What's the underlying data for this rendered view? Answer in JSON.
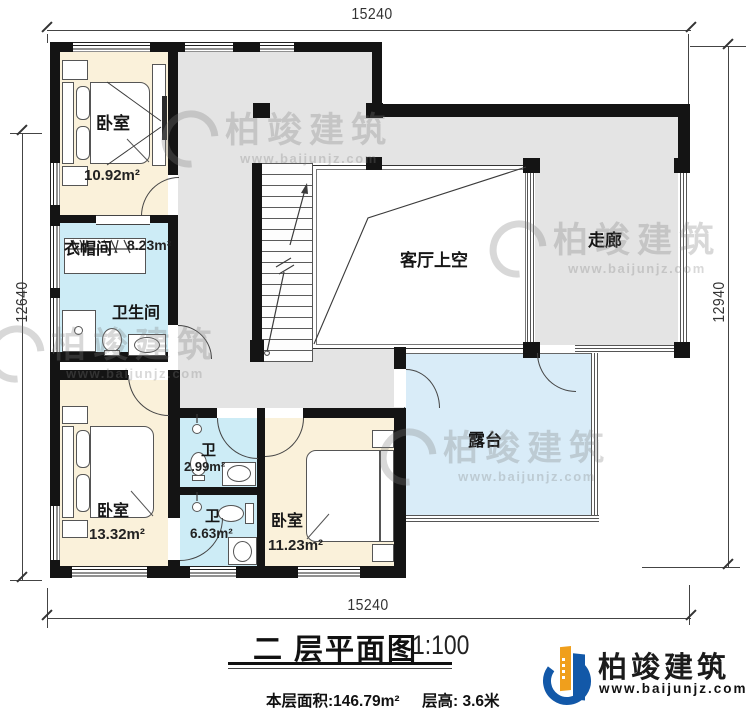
{
  "plan": {
    "dims": {
      "top": "15240",
      "bottom": "15240",
      "left": "12640",
      "right": "12940"
    },
    "rooms": {
      "bedroom_top": {
        "label": "卧室",
        "area": "10.92m²"
      },
      "cloakroom": {
        "label": "衣帽间",
        "area": "8.23m²"
      },
      "bathroom_main": {
        "label": "卫生间"
      },
      "living_void": {
        "label": "客厅上空"
      },
      "corridor": {
        "label": "走廊"
      },
      "bedroom_left": {
        "label": "卧室",
        "area": "13.32m²"
      },
      "bath_small": {
        "label": "卫",
        "area": "2.99m²"
      },
      "bath_ensuite": {
        "label": "卫",
        "area": "6.63m²"
      },
      "bedroom_right": {
        "label": "卧室",
        "area": "11.23m²"
      },
      "terrace": {
        "label": "露台"
      }
    }
  },
  "title_block": {
    "title": "二 层平面图",
    "scale": "1:100",
    "floor_area": "本层面积:146.79m²",
    "floor_height": "层高: 3.6米"
  },
  "branding": {
    "company": "柏竣建筑",
    "website": "www.baijunjz.com"
  },
  "watermark": {
    "company": "柏竣建筑",
    "website": "www.baijunjz.com"
  },
  "colors": {
    "wall": "#141414",
    "floor-cream": "#faf1da",
    "floor-wet": "#cdecf6",
    "floor-gray": "#e4e4e4",
    "floor-terrace": "#d9ecf8",
    "brand-blue": "#1258a8",
    "brand-orange": "#f09f1c"
  }
}
